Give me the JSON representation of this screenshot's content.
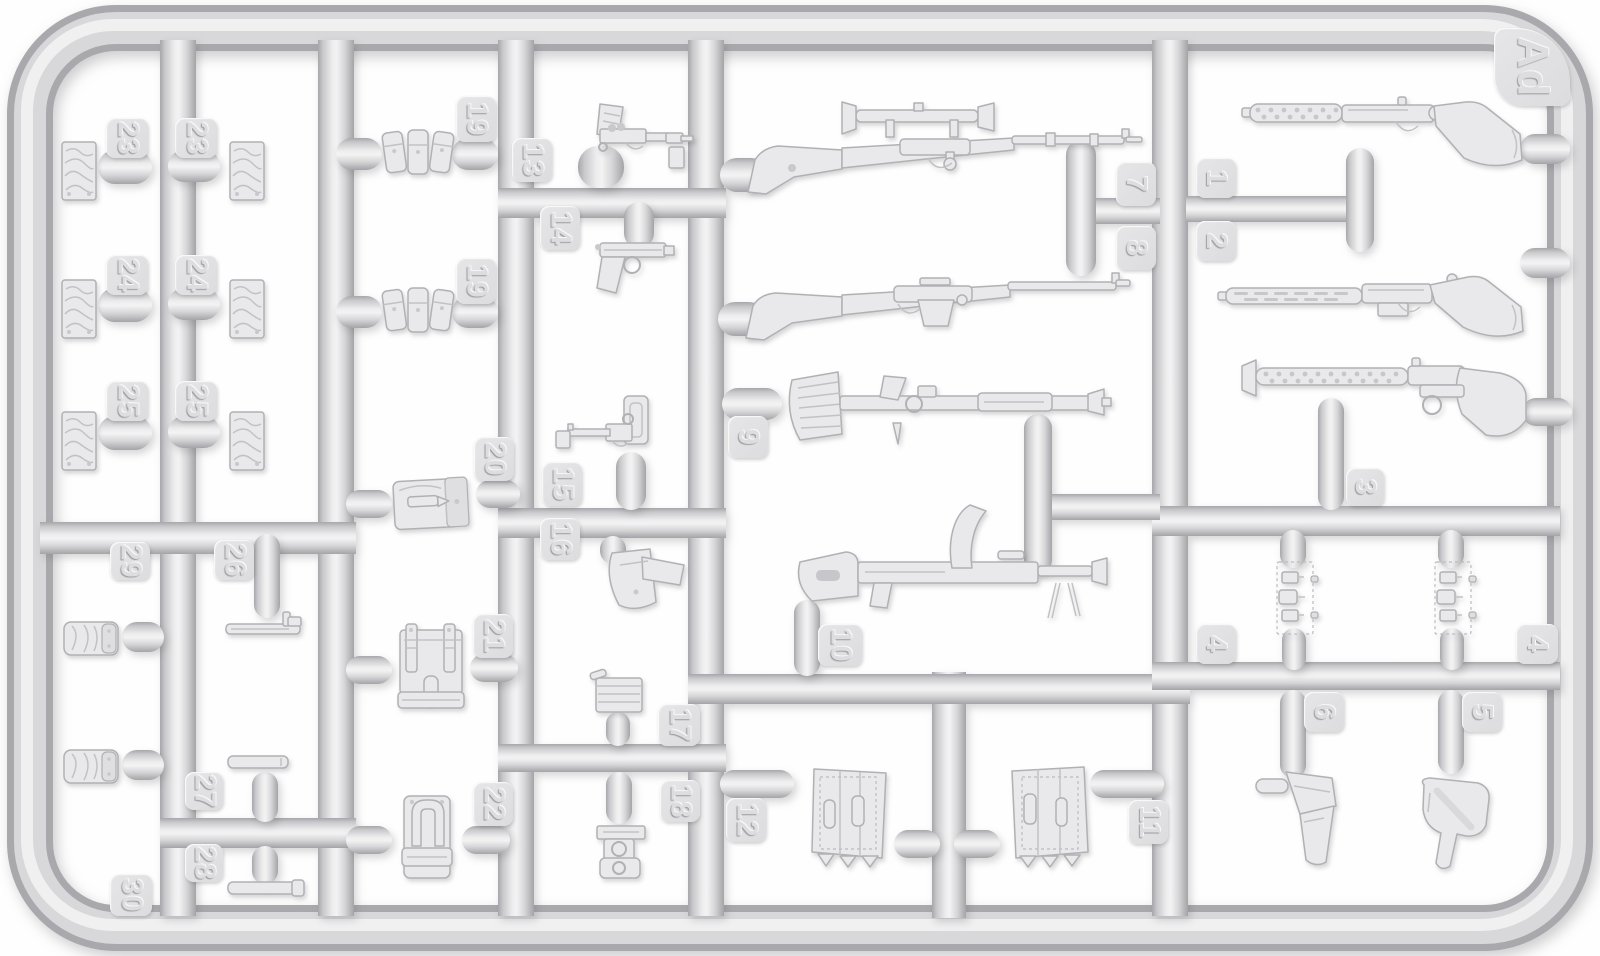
{
  "scene": {
    "description": "Injection-molded plastic model kit sprue (light grey styrene) with WWII small-arms and equipment parts",
    "sprue_letter": "Ad",
    "colors": {
      "background": "#ffffff",
      "plastic_base": "#d9d9db",
      "plastic_highlight": "#f1f1f2",
      "plastic_shadow": "#a8a8ac",
      "part_fill": "#e9e9eb"
    }
  },
  "tabs": {
    "ad": "Ad",
    "t1": "1",
    "t2": "2",
    "t3": "3",
    "t4a": "4",
    "t4b": "4",
    "t5": "5",
    "t6": "6",
    "t7": "7",
    "t8": "8",
    "t9": "9",
    "t10": "10",
    "t11": "11",
    "t12": "12",
    "t13": "13",
    "t14": "14",
    "t15": "15",
    "t16": "16",
    "t17": "17",
    "t18": "18",
    "t19a": "19",
    "t19b": "19",
    "t20": "20",
    "t21": "21",
    "t22": "22",
    "t23a": "23",
    "t23b": "23",
    "t24a": "24",
    "t24b": "24",
    "t25a": "25",
    "t25b": "25",
    "t26": "26",
    "t27": "27",
    "t28": "28",
    "t29": "29",
    "t30": "30"
  },
  "parts": [
    {
      "number": "1",
      "item": "submachine gun with perforated barrel jacket"
    },
    {
      "number": "2",
      "item": "submachine gun with slotted barrel jacket"
    },
    {
      "number": "3",
      "item": "submachine gun with full wooden stock"
    },
    {
      "number": "4",
      "item": "triple magazine pouch plate",
      "quantity": 2
    },
    {
      "number": "5",
      "item": "pistol holster"
    },
    {
      "number": "6",
      "item": "pistol holster"
    },
    {
      "number": "7",
      "item": "bolt-action rifle with telescopic sight"
    },
    {
      "number": "8",
      "item": "semi-automatic rifle"
    },
    {
      "number": "9",
      "item": "automatic rifle with flared ribbed stock"
    },
    {
      "number": "10",
      "item": "light machine gun with curved top magazine"
    },
    {
      "number": "11",
      "item": "ammunition bag"
    },
    {
      "number": "12",
      "item": "ammunition bag"
    },
    {
      "number": "13",
      "item": "pistol"
    },
    {
      "number": "14",
      "item": "pistol"
    },
    {
      "number": "15",
      "item": "pistol with shoulder stock"
    },
    {
      "number": "16",
      "item": "pistol holster"
    },
    {
      "number": "17",
      "item": "ammunition box"
    },
    {
      "number": "18",
      "item": "optical sight parts"
    },
    {
      "number": "19",
      "item": "three-cell magazine pouch",
      "quantity": 2
    },
    {
      "number": "20",
      "item": "ammunition pouch with clip"
    },
    {
      "number": "21",
      "item": "pack pouch with straps"
    },
    {
      "number": "22",
      "item": "equipment pouch"
    },
    {
      "number": "23",
      "item": "folded cloth piece",
      "quantity": 2
    },
    {
      "number": "24",
      "item": "folded cloth piece",
      "quantity": 2
    },
    {
      "number": "25",
      "item": "folded cloth piece",
      "quantity": 2
    },
    {
      "number": "26",
      "item": "flat bar with small fitting"
    },
    {
      "number": "27",
      "item": "flat bar"
    },
    {
      "number": "28",
      "item": "flat bar with tip"
    },
    {
      "number": "29",
      "item": "rolled kit bundle"
    },
    {
      "number": "30",
      "item": "rolled kit bundle"
    }
  ]
}
